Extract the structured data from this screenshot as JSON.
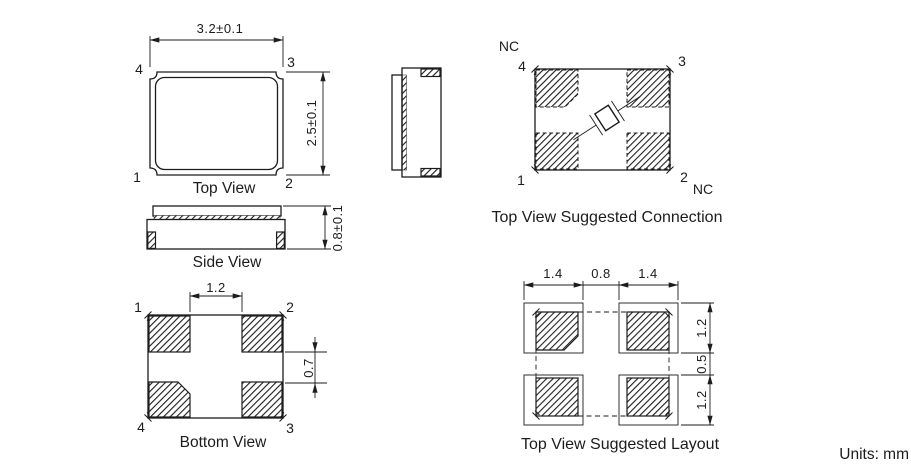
{
  "page": {
    "units_note": "Units: mm"
  },
  "views": {
    "top": {
      "title": "Top View",
      "dims": {
        "width": "3.2±0.1",
        "height": "2.5±0.1"
      },
      "pins": {
        "top_left": "4",
        "top_right": "3",
        "bottom_left": "1",
        "bottom_right": "2"
      }
    },
    "side": {
      "title": "Side View",
      "dims": {
        "height": "0.8±0.1"
      }
    },
    "bottom": {
      "title": "Bottom View",
      "dims": {
        "pad_inner_gap": "1.2",
        "pad_vertical_gap": "0.7"
      },
      "pins": {
        "top_left": "1",
        "top_right": "2",
        "bottom_left": "4",
        "bottom_right": "3"
      }
    },
    "connection": {
      "title": "Top View Suggested Connection",
      "nc_top": "NC",
      "nc_bottom": "NC",
      "pins": {
        "top_left": "4",
        "top_right": "3",
        "bottom_left": "1",
        "bottom_right": "2"
      }
    },
    "layout": {
      "title": "Top View Suggested Layout",
      "dims": {
        "pad_width_left": "1.4",
        "pad_gap_x": "0.8",
        "pad_width_right": "1.4",
        "pad_height_top": "1.2",
        "pad_gap_y": "0.5",
        "pad_height_bottom": "1.2"
      }
    }
  },
  "colors": {
    "line": "#1c1c1c",
    "background": "#ffffff"
  }
}
